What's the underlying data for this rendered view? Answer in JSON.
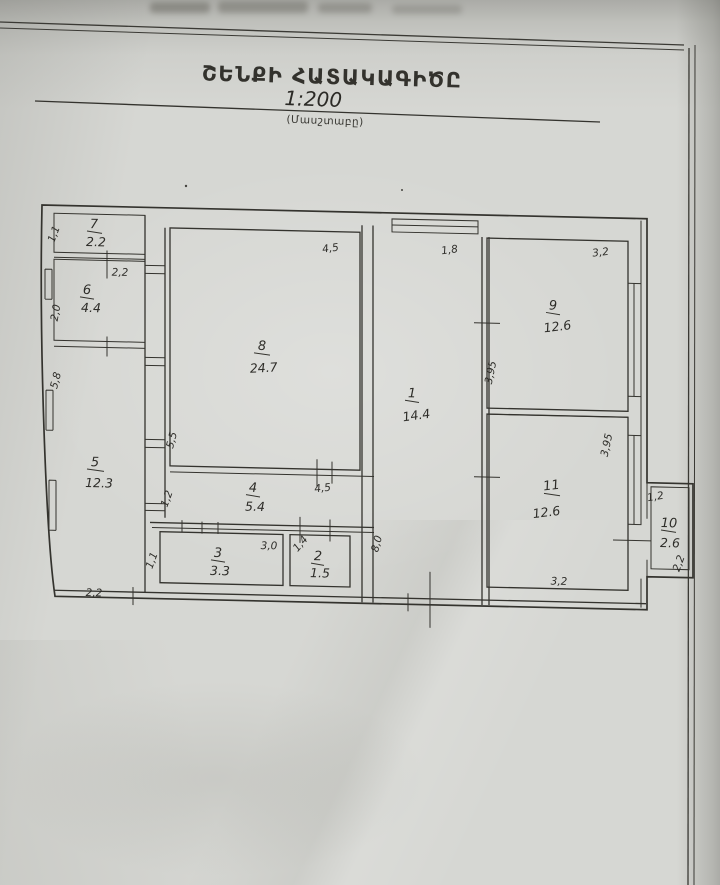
{
  "page": {
    "title": "ՇԵՆՔԻ ՀԱՏԱԿԱԳԻԾԸ",
    "scale": "1:200",
    "scale_caption": "(Մասշտաբը)"
  },
  "plan": {
    "rooms": {
      "r1": {
        "number": "1",
        "area": "14.4"
      },
      "r2": {
        "number": "2",
        "area": "1.5"
      },
      "r3": {
        "number": "3",
        "area": "3.3"
      },
      "r4": {
        "number": "4",
        "area": "5.4"
      },
      "r5": {
        "number": "5",
        "area": "12.3"
      },
      "r6": {
        "number": "6",
        "area": "4.4"
      },
      "r7": {
        "number": "7",
        "area": "2.2"
      },
      "r8": {
        "number": "8",
        "area": "24.7"
      },
      "r9": {
        "number": "9",
        "area": "12.6"
      },
      "r10": {
        "number": "10",
        "area": "2.6"
      },
      "r11": {
        "number": "11",
        "area": "12.6"
      }
    },
    "dims": {
      "room7_left": "1,1",
      "room6_width": "2,2",
      "room6_left": "2,0",
      "left_wall": "5,8",
      "room5_bottom": "2,2",
      "room8_top": "4,5",
      "room8_left_lower": "5,5",
      "corridor_left": "1,2",
      "room4_right": "4,5",
      "room3_top": "3,0",
      "room3_left": "1,1",
      "room2_top": "1,4",
      "room1_top": "1,8",
      "room1_left": "8,0",
      "room9_top": "3,2",
      "room9_left": "3,95",
      "room11_right": "3,95",
      "room11_bottom": "3,2",
      "room10_top": "1,2",
      "room10_right": "2,2"
    }
  }
}
